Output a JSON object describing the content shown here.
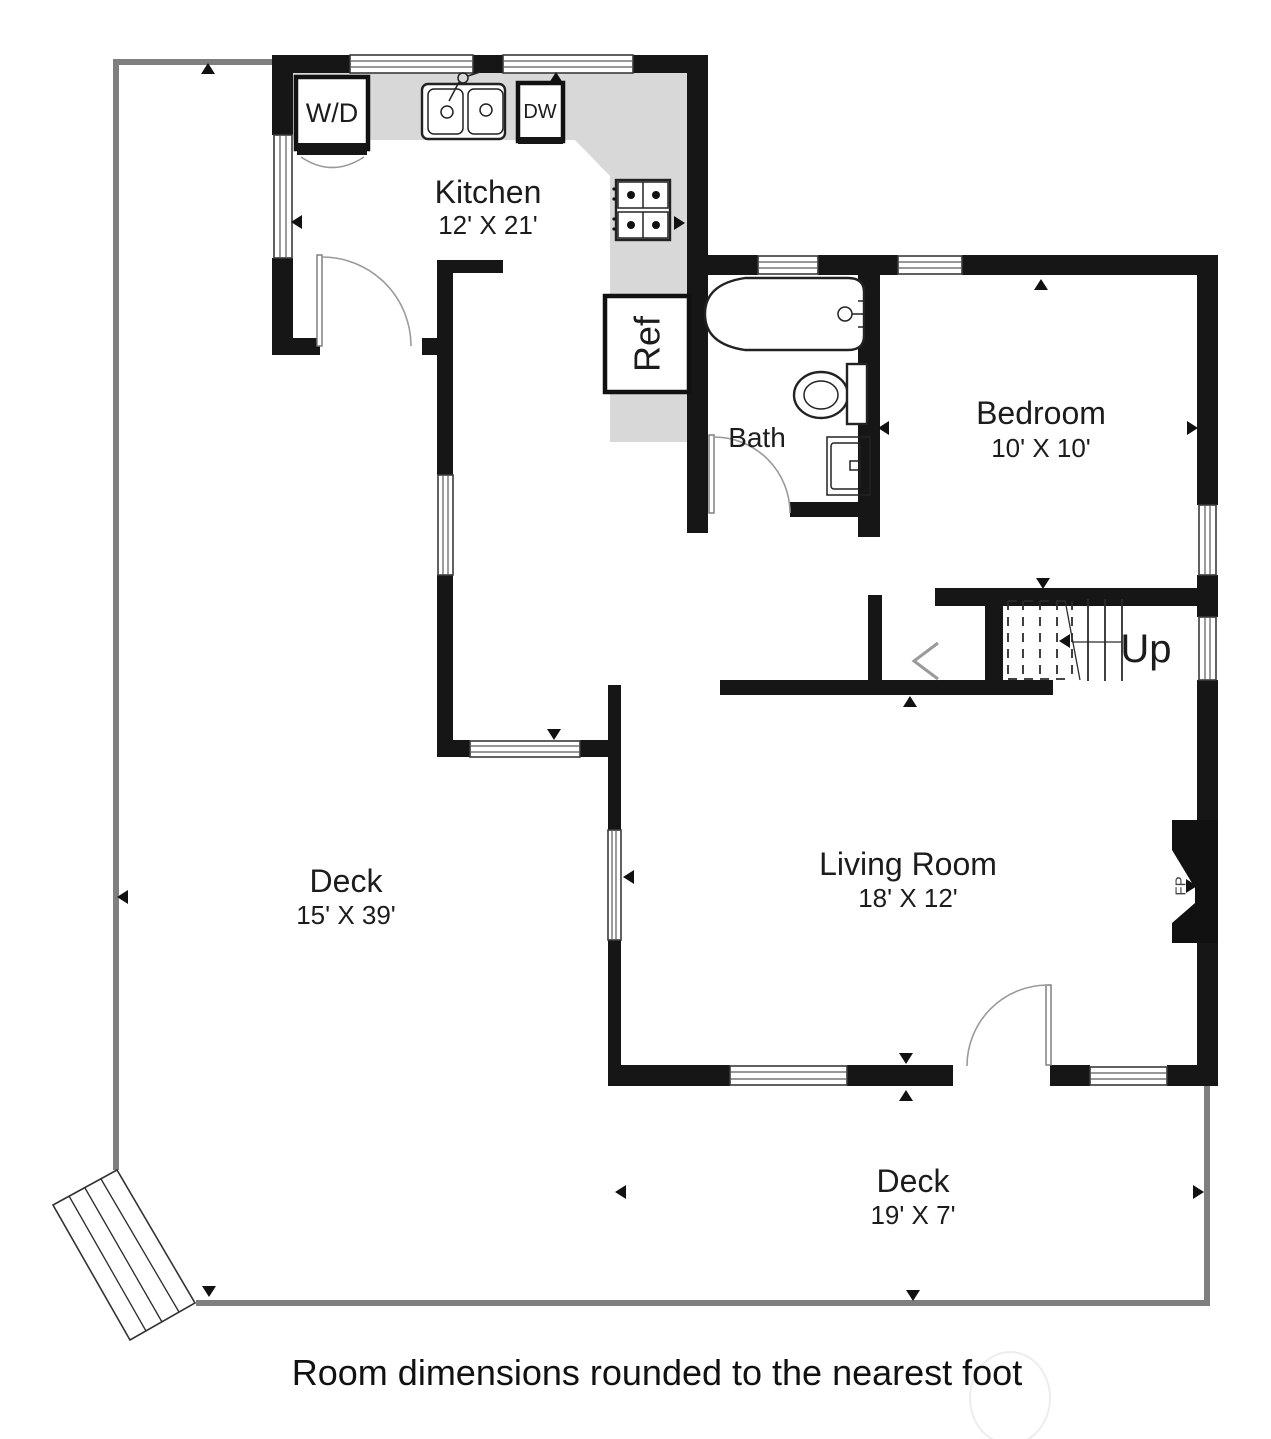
{
  "labels": {
    "kitchen": "Kitchen",
    "kitchen_dims": "12' X 21'",
    "bath": "Bath",
    "bedroom": "Bedroom",
    "bedroom_dims": "10' X 10'",
    "living_room": "Living Room",
    "living_room_dims": "18' X 12'",
    "deck_left": "Deck",
    "deck_left_dims": "15' X 39'",
    "deck_bottom": "Deck",
    "deck_bottom_dims": "19' X 7'",
    "washer_dryer": "W/D",
    "dishwasher": "DW",
    "refrigerator": "Ref",
    "fireplace": "FP",
    "stairs_up": "Up",
    "caption": "Room dimensions rounded to the nearest foot"
  },
  "colors": {
    "wall": "#161616",
    "counter": "#d8d8d8",
    "deck_line": "#7f7f7f",
    "background": "#ffffff"
  }
}
